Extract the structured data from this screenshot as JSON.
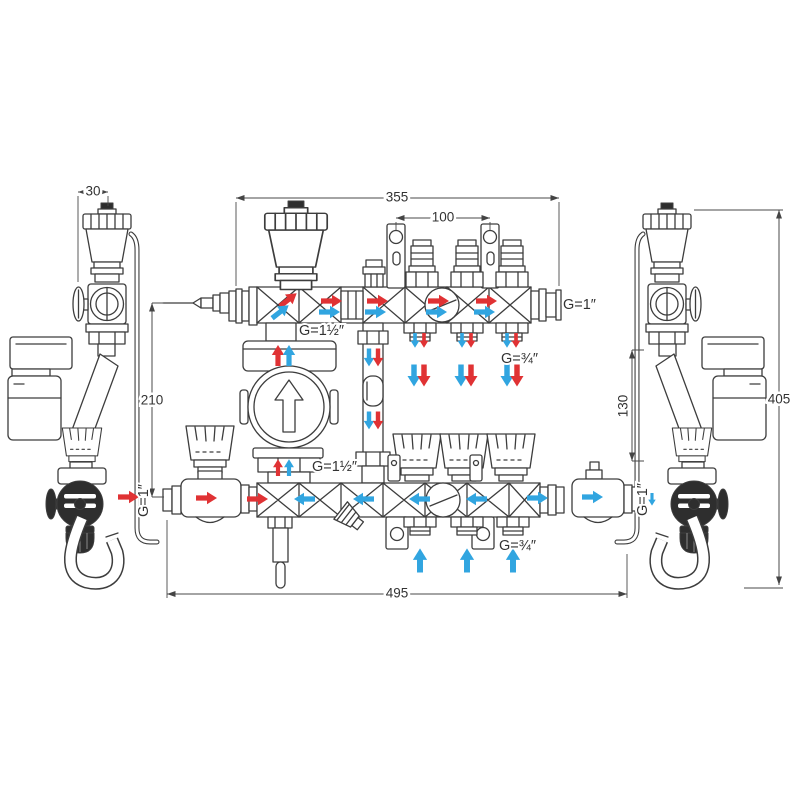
{
  "diagram": {
    "kind": "technical-drawing",
    "subject": "heating manifold mixing unit with pump, front view and two side views"
  },
  "dimensions": {
    "vent_offset": "30",
    "manifold_width": "355",
    "bracket_spacing": "100",
    "bar_spacing": "210",
    "side_connection_height": "130",
    "total_height": "405",
    "total_width": "495"
  },
  "connections": {
    "top_manifold_left": "G=1½″",
    "top_manifold_right": "G=1″",
    "top_outlets": "G=¾″",
    "pump_line": "G=1½″",
    "bottom_inlet_left": "G=1″",
    "bottom_outlets": "G=¾″",
    "bottom_outlet_right": "G=1″"
  },
  "colors": {
    "line": "#3d3d3d",
    "dimension": "#4a4a4a",
    "flow_supply_red": "#e03234",
    "flow_return_blue": "#31a5e0",
    "background": "#ffffff"
  }
}
